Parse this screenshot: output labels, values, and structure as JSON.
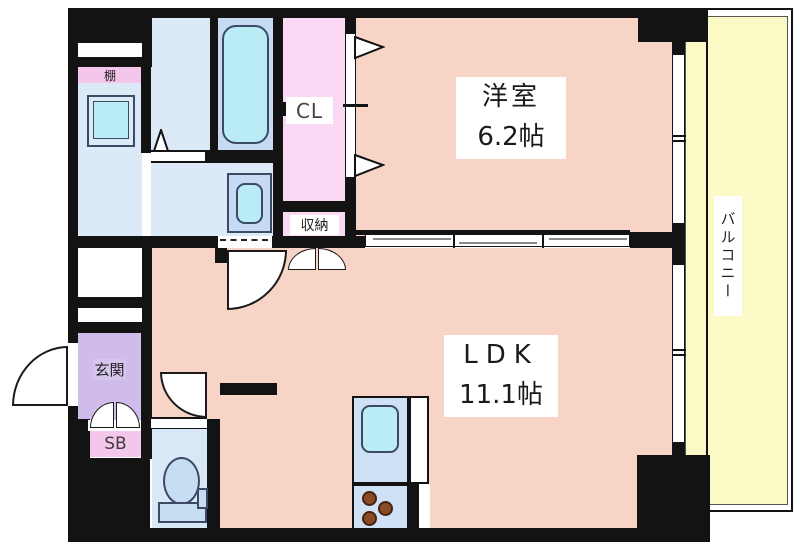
{
  "title": "1LDK apartment floor plan",
  "labels": {
    "shelf": "棚",
    "closet": "CL",
    "storage": "収納",
    "western_room_name": "洋室",
    "western_room_area": "6.2帖",
    "ldk_name": "LDK",
    "ldk_area": "11.1帖",
    "entrance": "玄関",
    "shoe_box": "SB",
    "balcony": "バルコニー"
  },
  "colors": {
    "wall": "#131313",
    "room_salmon": "#f8d4c6",
    "wet_area_blue": "#dce9f7",
    "bath_blue": "#c6daf3",
    "fixture_cyan": "#b9ecf4",
    "closet_pink": "#f9d9f4",
    "accent_pink": "#f5c6ec",
    "entrance_purple": "#cfbcea",
    "balcony_yellow": "#fbf9c5",
    "burner_brown": "#8a4a26"
  }
}
